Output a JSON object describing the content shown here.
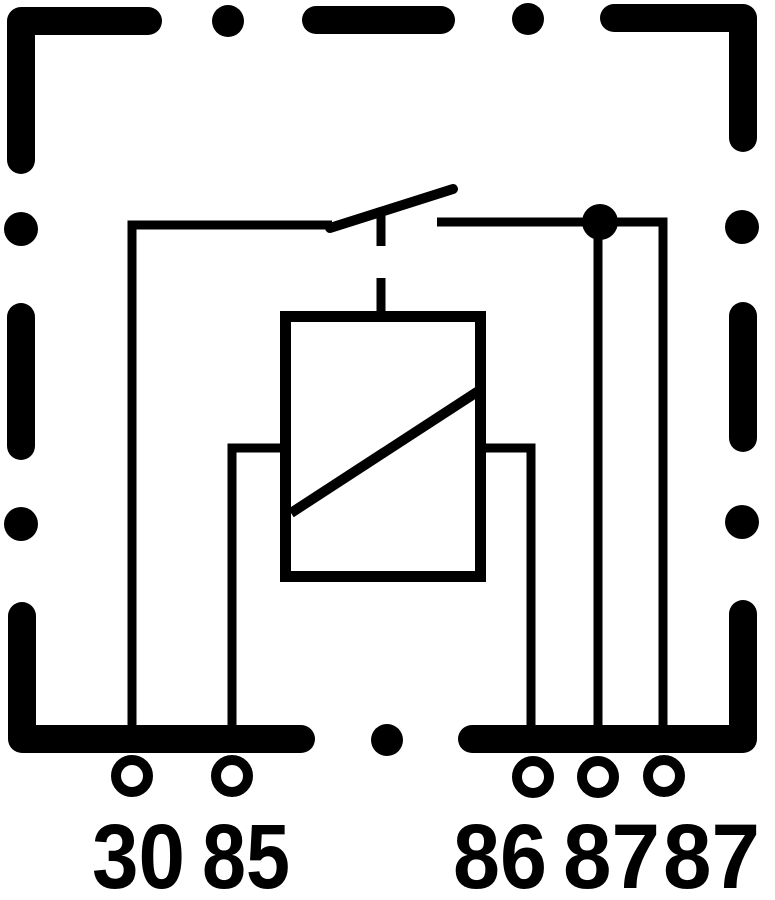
{
  "diagram": {
    "kind": "relay-wiring-schematic",
    "colors": {
      "ink": "#000000",
      "background": "#ffffff"
    },
    "terminals": [
      {
        "id": "30",
        "label": "30"
      },
      {
        "id": "85",
        "label": "85"
      },
      {
        "id": "86",
        "label": "86"
      },
      {
        "id": "87-1",
        "label": "87"
      },
      {
        "id": "87-2",
        "label": "87"
      }
    ]
  }
}
